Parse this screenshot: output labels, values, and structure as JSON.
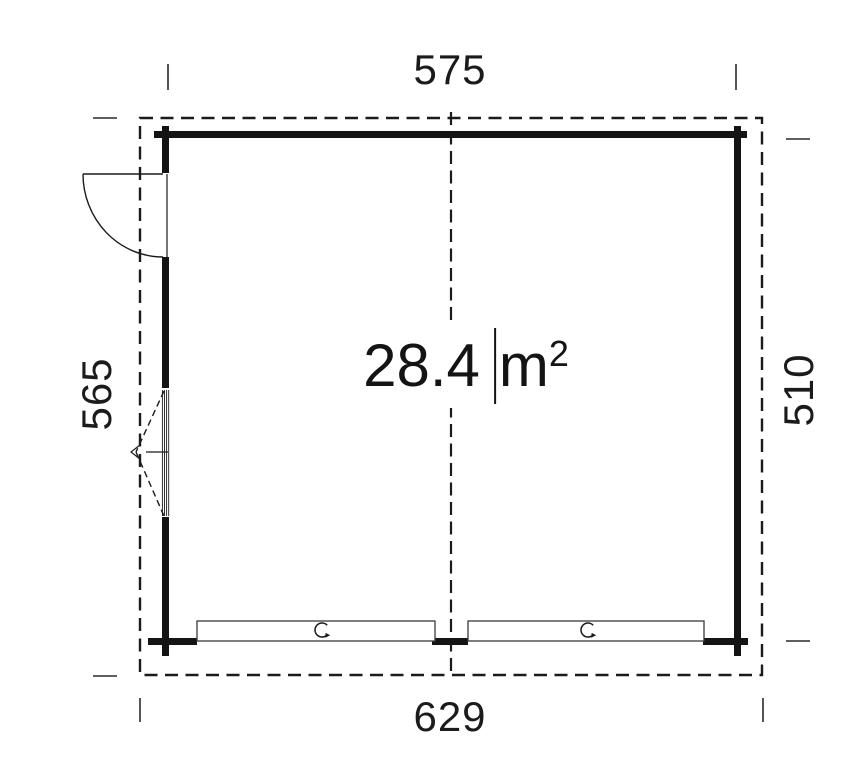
{
  "drawing": {
    "type": "garage-floor-plan",
    "area_label": {
      "value": "28.4",
      "unit_base": "m",
      "unit_exponent": "2"
    },
    "dimensions": {
      "top": {
        "label": "575"
      },
      "bottom": {
        "label": "629"
      },
      "left": {
        "label": "565"
      },
      "right": {
        "right_side": true,
        "label": "510"
      }
    },
    "features": {
      "entry_door": "single swing door, top-left, opens outward",
      "window": "fixed window with opening indicator, left wall",
      "garage_doors": [
        "sectional door left",
        "sectional door right"
      ],
      "handle_icon": "rotary-handle-icon"
    },
    "colors": {
      "ink": "#1b1b1b",
      "wall_fill": "#141414",
      "thin_line": "#3a3a3a",
      "background": "#ffffff"
    }
  }
}
